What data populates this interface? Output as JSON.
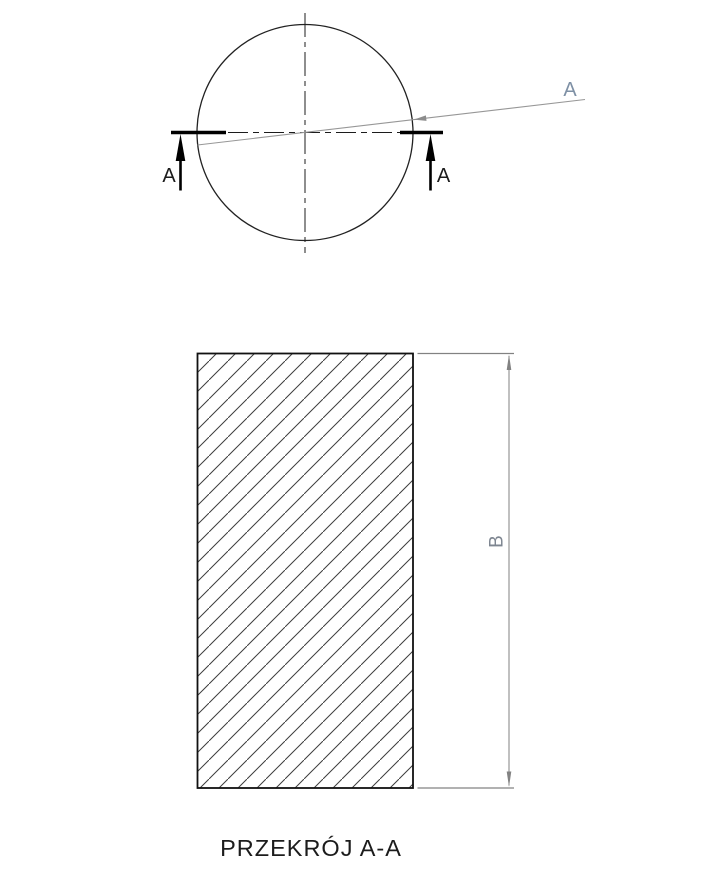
{
  "drawing": {
    "view_title": "PRZEKRÓJ A-A",
    "section_marks": {
      "left_label": "A",
      "right_label": "A"
    },
    "view_leader": {
      "label": "A"
    },
    "dimension_b": {
      "label": "B"
    },
    "colors": {
      "ink": "#1c1c1c",
      "dimension_gray": "#828282",
      "leader_gray": "#979797",
      "leader_label_gray": "#7e90a5",
      "dim_label_gray": "#7e8691",
      "hatch_gray": "#3d3d3d"
    }
  }
}
